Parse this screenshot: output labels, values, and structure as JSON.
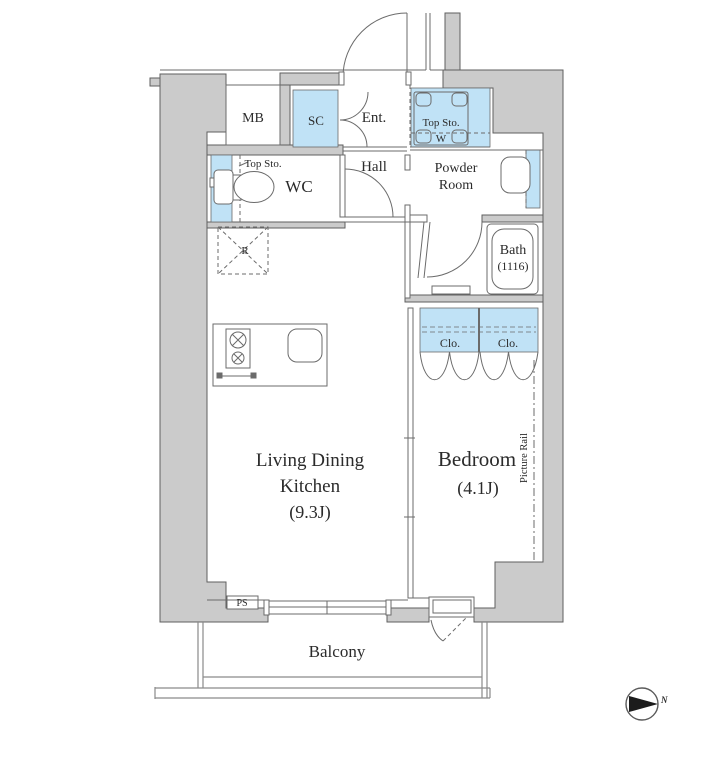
{
  "plan": {
    "title": "apartment-floor-plan",
    "labels": {
      "mb": "MB",
      "sc": "SC",
      "ent": "Ent.",
      "top_sto_entry": "Top Sto.",
      "washer": "W",
      "hall": "Hall",
      "wc": "WC",
      "top_sto_wc": "Top Sto.",
      "powder_line1": "Powder",
      "powder_line2": "Room",
      "bath_line1": "Bath",
      "bath_line2": "(1116)",
      "fridge": "R",
      "closet_left": "Clo.",
      "closet_right": "Clo.",
      "ldk_line1": "Living Dining",
      "ldk_line2": "Kitchen",
      "ldk_line3": "(9.3J)",
      "bedroom_line1": "Bedroom",
      "bedroom_line2": "(4.1J)",
      "picture_rail": "Picture Rail",
      "ps": "PS",
      "balcony": "Balcony"
    },
    "compass": {
      "north_label": "N"
    },
    "colors": {
      "wall_fill": "#cbcbcb",
      "wall_outline": "#5f5f5f",
      "storage_blue": "#c0e2f6",
      "thin_line": "#6b6b6b",
      "text": "#2b2b2b"
    }
  }
}
